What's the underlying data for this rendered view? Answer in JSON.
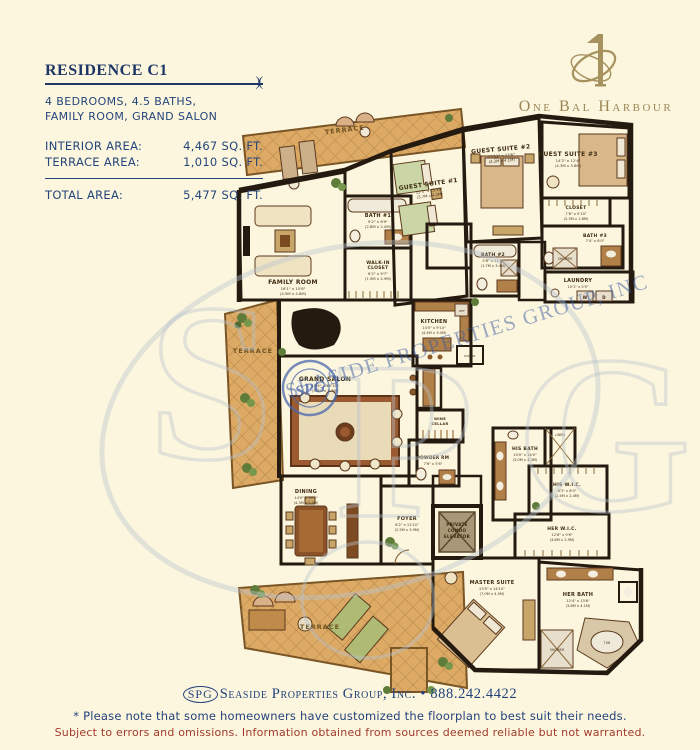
{
  "header": {
    "title": "RESIDENCE C1",
    "ornament": ")(",
    "subtitle_line1": "4 BEDROOMS, 4.5 BATHS,",
    "subtitle_line2": "FAMILY ROOM, GRAND SALON",
    "areas": [
      {
        "label": "INTERIOR AREA:",
        "value": "4,467 SQ. FT."
      },
      {
        "label": "TERRACE AREA:",
        "value": "1,010 SQ. FT."
      }
    ],
    "total": {
      "label": "TOTAL AREA:",
      "value": "5,477 SQ. FT."
    }
  },
  "brand": {
    "name": "One Bal Harbour",
    "color": "#9A8756"
  },
  "floorplan": {
    "watermark": {
      "stamp_text": "SPG",
      "diagonal_text": "SEASIDE PROPERTIES GROUP, INC",
      "monogram": [
        "S",
        "P",
        "G"
      ]
    },
    "rooms": {
      "terrace_top": {
        "label": "TERRACE"
      },
      "terrace_left": {
        "label": "TERRACE"
      },
      "terrace_bottom": {
        "label": "TERRACE"
      },
      "family": {
        "label": "FAMILY ROOM",
        "dims": "16'1\" x 15'8\"",
        "metric": "(4.9M x 4.8M)"
      },
      "bath1": {
        "label": "BATH #1",
        "dims": "9'2\" x 6'9\"",
        "metric": "(2.8M x 2.0M)"
      },
      "walkin": {
        "label_l1": "WALK-IN",
        "label_l2": "CLOSET",
        "dims": "6'2\" x 9'7\"",
        "metric": "(1.9M x 2.9M)"
      },
      "guest1": {
        "label": "GUEST SUITE #1",
        "dims": "12'3\" x 13'10\"",
        "metric": "(3.7M x 4.2M)"
      },
      "guest2": {
        "label": "GUEST SUITE #2",
        "dims": "13'11\" x 13'6\"",
        "metric": "(4.2M x 4.1M)"
      },
      "guest3": {
        "label": "GUEST SUITE #3",
        "dims": "14'2\" x 12'4\"",
        "metric": "(4.3M x 3.8M)"
      },
      "bath2": {
        "label": "BATH #2",
        "dims": "5'6\" x 11'2\"",
        "metric": "(1.7M x 3.4M)"
      },
      "closet3": {
        "label": "CLOSET",
        "dims": "7'6\" x 5'10\"",
        "metric": "(2.3M x 1.8M)"
      },
      "bath3": {
        "label": "BATH #3",
        "dims": "7'4\" x 8'0\"",
        "metric": "(2.2M x 2.4M)"
      },
      "shower3": {
        "label": "SHOWER"
      },
      "laundry": {
        "label": "LAUNDRY",
        "dims": "10'1\" x 5'5\"",
        "metric": "(3.1M x 1.7M)"
      },
      "washer": {
        "label": "W"
      },
      "dryer": {
        "label": "D"
      },
      "kitchen": {
        "label": "KITCHEN",
        "dims": "14'5\" x 9'10\"",
        "metric": "(4.4M x 3.0M)"
      },
      "ref": {
        "label": "REF"
      },
      "pantry": {
        "label": "PANTRY"
      },
      "salon": {
        "label": "GRAND SALON",
        "dims": "19'6\" x 18'10\"",
        "metric": "(5.9M x 5.7M)"
      },
      "dining": {
        "label": "DINING",
        "dims": "14'0\" x 16'5\"",
        "metric": "(4.3M x 5.0M)"
      },
      "foyer": {
        "label": "FOYER",
        "dims": "8'2\" x 12'10\"",
        "metric": "(2.5M x 3.9M)"
      },
      "elevator": {
        "label_l1": "PRIVATE",
        "label_l2": "CONDO",
        "label_l3": "ELEVATOR"
      },
      "wine": {
        "label_l1": "WINE",
        "label_l2": "CELLAR"
      },
      "powder": {
        "label": "POWDER RM",
        "dims": "7'6\" x 5'6\"",
        "metric": "(2.3M x 1.7M)"
      },
      "his_bath": {
        "label": "HIS BATH",
        "dims": "10'0\" x 14'0\"",
        "metric": "(3.0M x 4.3M)"
      },
      "linen": {
        "label": "LINEN"
      },
      "his_wic": {
        "label": "HIS W.I.C.",
        "dims": "8'3\" x 8'0\"",
        "metric": "(2.4M x 2.4M)"
      },
      "her_wic": {
        "label": "HER W.I.C.",
        "dims": "12'6\" x 9'6\"",
        "metric": "(3.8M x 2.9M)"
      },
      "master": {
        "label": "MASTER SUITE",
        "dims": "23'0\" x 14'10\"",
        "metric": "(7.0M x 4.5M)"
      },
      "her_bath": {
        "label": "HER BATH",
        "dims": "12'4\" x 13'6\"",
        "metric": "(3.8M x 4.1M)"
      },
      "shower_master": {
        "label": "SHOWER"
      },
      "tub": {
        "label": "TUB"
      }
    }
  },
  "footer": {
    "spg_badge": "SPG",
    "company": "Seaside Properties Group, Inc.",
    "bullet": "•",
    "phone": "888.242.4422",
    "note": "* Please note that some homeowners have customized the floorplan to best suit their needs.",
    "disclaimer": "Subject to errors and omissions. Information obtained from sources deemed reliable but not warranted."
  }
}
